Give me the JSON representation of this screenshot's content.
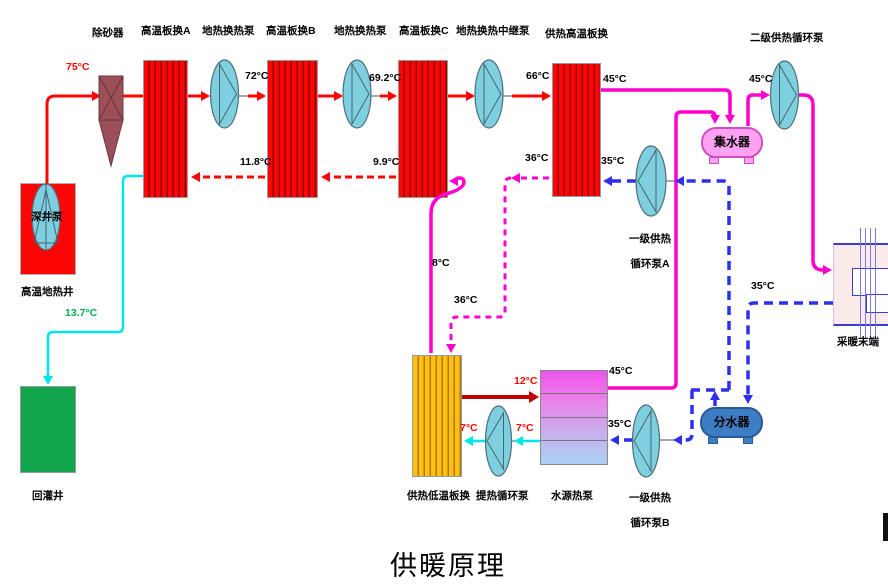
{
  "title": "供暖原理",
  "colors": {
    "geothermal_supply": "#fe0505",
    "reinjection_line": "#00e6e6",
    "secondary_supply": "#ff00ce",
    "secondary_return": "#2f2ff2",
    "low_temp_supply": "#c00000",
    "pump_fill": "#7ecfdf",
    "connector_gray": "#8a8a8a",
    "sand_remover_fill": "#9c4f58",
    "sand_remover_stroke": "#6d343b"
  },
  "equipment": {
    "sand_remover": "除砂器",
    "hx_a": "高温板换A",
    "geo_pump_1": "地热换热泵",
    "hx_b": "高温板换B",
    "geo_pump_2": "地热换热泵",
    "hx_c": "高温板换C",
    "relay_pump": "地热换热中继泵",
    "hx_supply_high": "供热高温板换",
    "secondary_pump": "二级供热循环泵",
    "deep_well_pump": "深井泵",
    "geothermal_well": "高温地热井",
    "reinjection_well": "回灌井",
    "collector": "集水器",
    "distributor": "分水器",
    "primary_pump_a_line1": "一级供热",
    "primary_pump_a_line2": "循环泵A",
    "primary_pump_b_line1": "一级供热",
    "primary_pump_b_line2": "循环泵B",
    "hx_supply_low": "供热低温板换",
    "lift_pump": "提热循环泵",
    "water_source_heat_pump": "水源热泵",
    "heating_terminal": "采暖末端"
  },
  "temperatures": {
    "well_out": "75°C",
    "after_hx_a": "72°C",
    "after_hx_b": "69.2°C",
    "after_hx_c": "66°C",
    "return_to_hx_a": "11.8°C",
    "return_to_hx_b": "9.9°C",
    "reinjection": "13.7°C",
    "hx_c_out_low": "8°C",
    "hx_high_out_supply": "45°C",
    "collector_to_pump": "45°C",
    "wshp_supply": "45°C",
    "hx_high_return": "35°C",
    "wshp_return": "35°C",
    "terminal_return": "35°C",
    "hx_high_bypass": "36°C",
    "to_low_hx": "36°C",
    "low_hx_supply": "12°C",
    "low_hx_return_1": "7°C",
    "low_hx_return_2": "7°C"
  }
}
